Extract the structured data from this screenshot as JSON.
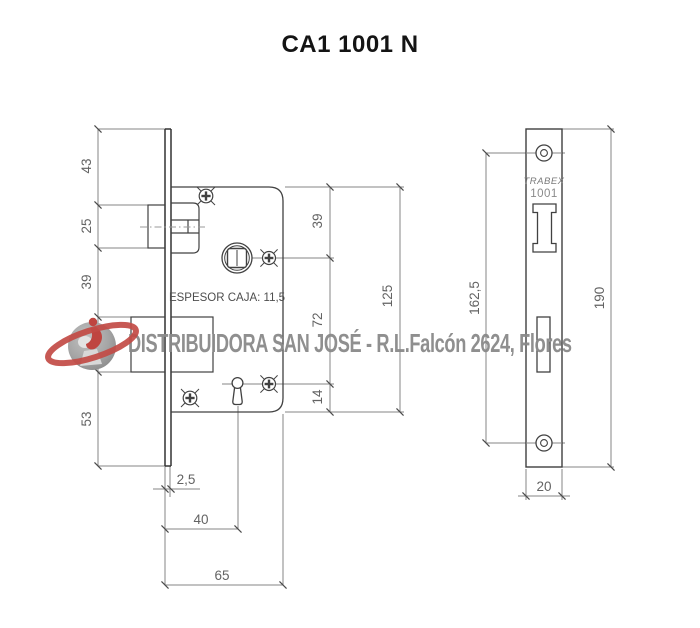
{
  "title": "CA1 1001 N",
  "watermark": {
    "company": "DISTRIBUIDORA SAN JOSÉ - R.L.Falcón 2624, Flores",
    "logo": "saturn-ring-lock-logo",
    "text_color": "#8a8a8a",
    "logo_red": "#c0453f",
    "logo_gray": "#a9a9a9"
  },
  "side_view": {
    "espesor_label": "ESPESOR CAJA: 11,5",
    "dim_top_section": "43",
    "dim_latch_height": "25",
    "dim_mid_section": "39",
    "dim_bolt_height": "30",
    "dim_bottom_section": "53",
    "dim_top_to_spindle": "39",
    "dim_spindle_to_key": "72",
    "dim_key_to_bottom": "14",
    "dim_case_height": "125",
    "dim_plate_thickness": "2,5",
    "dim_backset": "40",
    "dim_case_depth": "65"
  },
  "front_view": {
    "brand": "TRABEX",
    "model": "1001",
    "dim_screw_distance": "162,5",
    "dim_plate_height": "190",
    "dim_plate_width": "20"
  },
  "colors": {
    "outline": "#414141",
    "dimension_lines": "#858585",
    "dimension_text": "#636363",
    "title_text": "#141414"
  }
}
